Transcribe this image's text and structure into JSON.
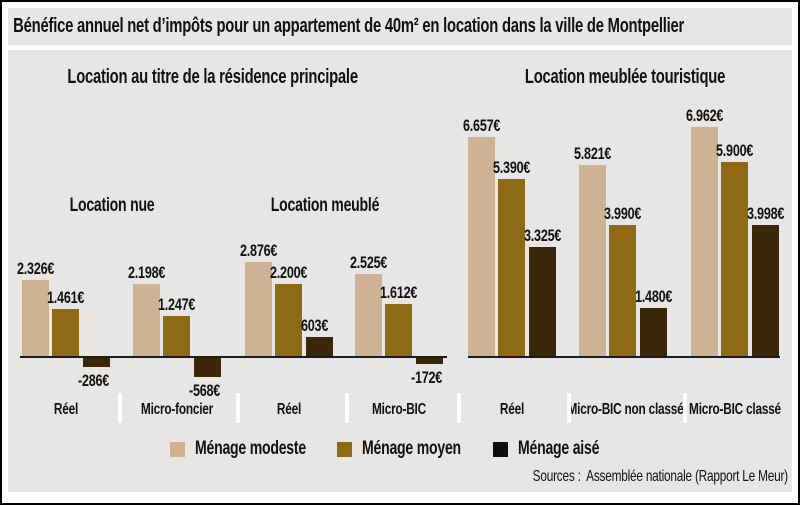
{
  "frame": {
    "title": "Bénéfice annuel net d’impôts pour un appartement de 40m² en location dans la ville de Montpellier"
  },
  "source": "Sources :  Assemblée nationale (Rapport Le Meur)",
  "legend": {
    "items": [
      {
        "label": "Ménage modeste",
        "color": "#cdb294"
      },
      {
        "label": "Ménage moyen",
        "color": "#8f6a14"
      },
      {
        "label": "Ménage aisé",
        "color": "#0d0d0d"
      }
    ]
  },
  "chart_data": {
    "type": "bar",
    "title": "Bénéfice annuel net d’impôts pour un appartement de 40m² en location dans la ville de Montpellier",
    "unit_suffix": "€",
    "series": [
      "Ménage modeste",
      "Ménage moyen",
      "Ménage aisé"
    ],
    "series_colors": [
      "#cdb294",
      "#8f6a14",
      "#3a2709"
    ],
    "ylim": [
      -800,
      7200
    ],
    "grid": false,
    "legend_position": "bottom",
    "sections": [
      {
        "title": "Location au titre de la résidence principale",
        "subgroups": [
          {
            "label": "Location nue",
            "categories": [
              {
                "label": "Réel",
                "values": [
                  2326,
                  1461,
                  -286
                ],
                "display": [
                  "2.326€",
                  "1.461€",
                  "-286€"
                ]
              },
              {
                "label": "Micro-foncier",
                "values": [
                  2198,
                  1247,
                  -568
                ],
                "display": [
                  "2.198€",
                  "1.247€",
                  "-568€"
                ]
              }
            ]
          },
          {
            "label": "Location meublé",
            "categories": [
              {
                "label": "Réel",
                "values": [
                  2876,
                  2200,
                  603
                ],
                "display": [
                  "2.876€",
                  "2.200€",
                  "603€"
                ]
              },
              {
                "label": "Micro-BIC",
                "values": [
                  2525,
                  1612,
                  -172
                ],
                "display": [
                  "2.525€",
                  "1.612€",
                  "-172€"
                ]
              }
            ]
          }
        ]
      },
      {
        "title": "Location meublée touristique",
        "subgroups": [
          {
            "label": "",
            "categories": [
              {
                "label": "Réel",
                "values": [
                  6657,
                  5390,
                  3325
                ],
                "display": [
                  "6.657€",
                  "5.390€",
                  "3.325€"
                ]
              },
              {
                "label": "Micro-BIC non classé",
                "values": [
                  5821,
                  3990,
                  1480
                ],
                "display": [
                  "5.821€",
                  "3.990€",
                  "1.480€"
                ]
              },
              {
                "label": "Micro-BIC classé",
                "values": [
                  6962,
                  5900,
                  3998
                ],
                "display": [
                  "6.962€",
                  "5.900€",
                  "3.998€"
                ]
              }
            ]
          }
        ]
      }
    ]
  }
}
